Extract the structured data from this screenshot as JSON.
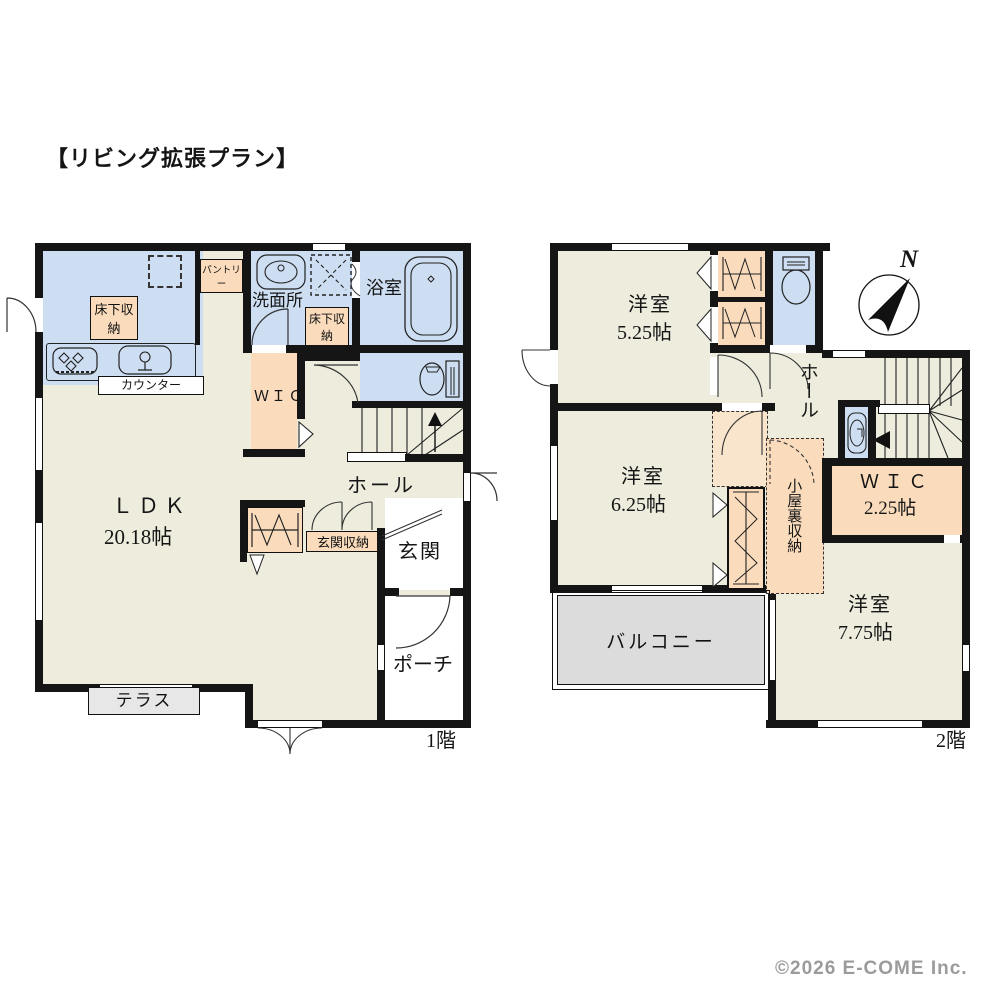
{
  "title": "【リビング拡張プラン】",
  "copyright": "©2026 E-COME Inc.",
  "floor1": {
    "floor_label": "1階",
    "ldk": "ＬＤＫ",
    "ldk_size": "20.18帖",
    "kitchen_floor_storage": "床下収納",
    "pantry": "パントリー",
    "counter": "カウンター",
    "washroom": "洗面所",
    "washroom_floor_storage": "床下収納",
    "bath": "浴室",
    "wic": "ＷＩＣ",
    "hall": "ホール",
    "entrance_storage": "玄関収納",
    "entrance": "玄関",
    "porch": "ポーチ",
    "terrace": "テラス"
  },
  "floor2": {
    "floor_label": "2階",
    "bedroom1": "洋室",
    "bedroom1_size": "5.25帖",
    "bedroom2": "洋室",
    "bedroom2_size": "6.25帖",
    "bedroom3": "洋室",
    "bedroom3_size": "7.75帖",
    "hall": "ホール",
    "wic": "ＷＩＣ",
    "wic_size": "2.25帖",
    "attic_storage": "小屋裏収納",
    "balcony": "バルコニー",
    "compass_north": "N"
  },
  "icons": {
    "stove": "stove-icon",
    "kitchen_sink": "kitchen-sink-icon",
    "vanity": "vanity-sink-icon",
    "washing_machine": "washing-machine-icon",
    "bathtub": "bathtub-icon",
    "toilet": "toilet-icon",
    "basin": "basin-icon",
    "compass": "compass-icon",
    "stairs": "stairs-icon",
    "hanger": "hanger-pipe-icon",
    "fridge_space": "fridge-space-outline"
  },
  "colors": {
    "wall": "#151515",
    "water_blue": "#cddef2",
    "storage_peach": "#fadcbd",
    "floor_cream": "#edecdd",
    "balcony_gray": "#dcdcdc",
    "terrace_gray": "#e7e7e7",
    "copyright_gray": "#9b9b9b"
  }
}
